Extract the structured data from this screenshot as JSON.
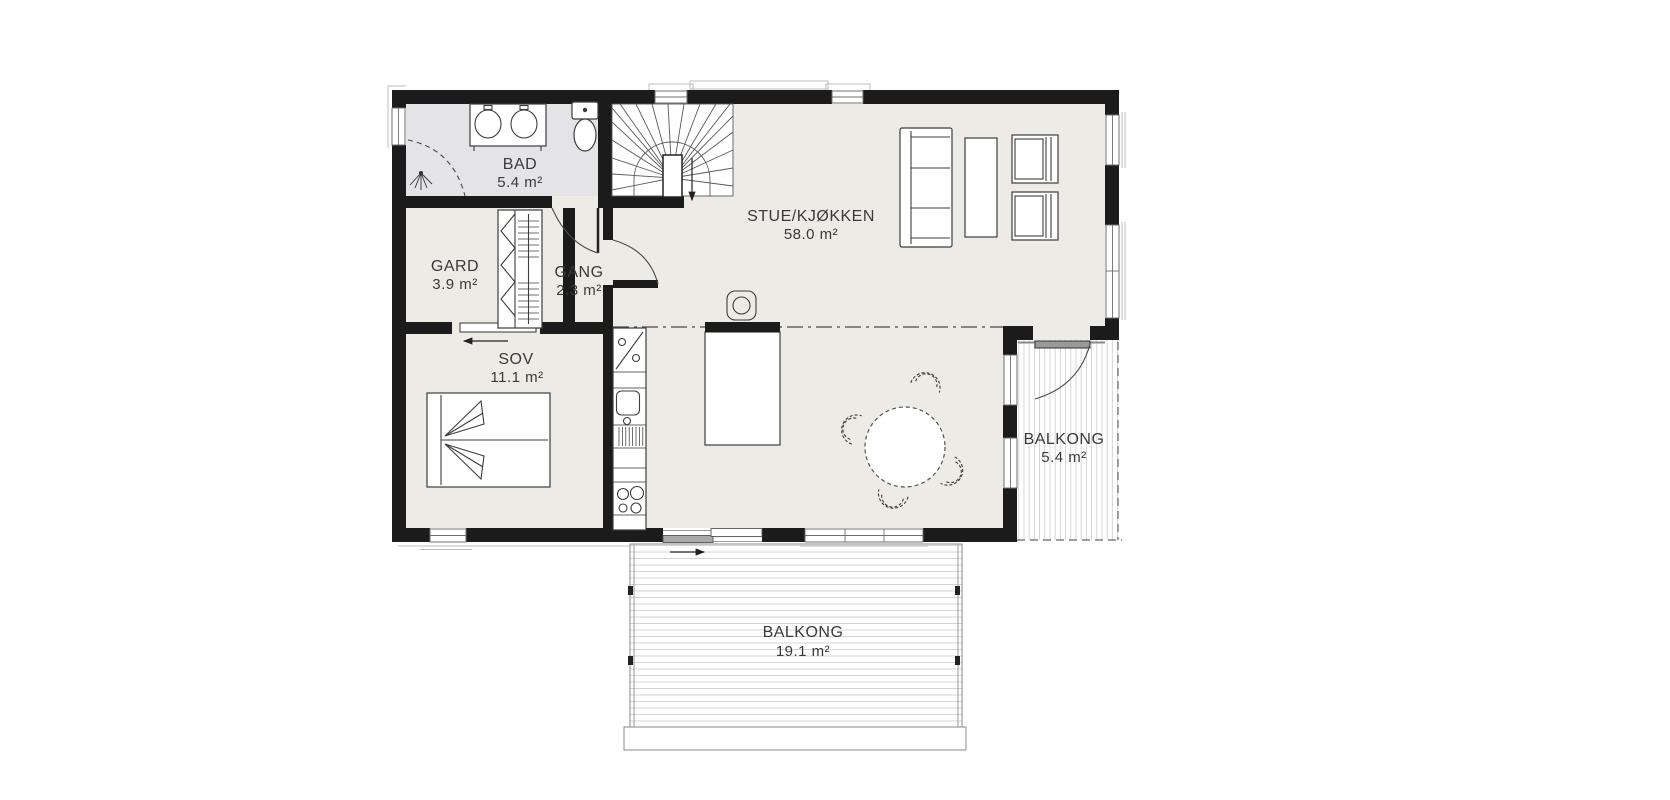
{
  "rooms": {
    "bad": {
      "label": "BAD",
      "area": "5.4 m²"
    },
    "gard": {
      "label": "GARD",
      "area": "3.9 m²"
    },
    "gang": {
      "label": "GANG",
      "area": "2.3 m²"
    },
    "sov": {
      "label": "SOV",
      "area": "11.1 m²"
    },
    "stue": {
      "label": "STUE/KJØKKEN",
      "area": "58.0 m²"
    },
    "balkong_side": {
      "label": "BALKONG",
      "area": "5.4 m²"
    },
    "balkong_front": {
      "label": "BALKONG",
      "area": "19.1 m²"
    }
  },
  "colors": {
    "wall": "#1b1b1b",
    "floor": "#ecebe6",
    "bathfloor": "#e4e4e7",
    "deckstripe": "#cfcfcf",
    "label": "#3a3a3a"
  },
  "furniture": [
    "stairs",
    "toilet",
    "double-sink",
    "shower",
    "wardrobe",
    "double-bed",
    "kitchen-counter",
    "dishwasher",
    "sink",
    "cooktop",
    "kitchen-island",
    "bar-stool",
    "dining-table",
    "dining-chair",
    "sofa",
    "coffee-table",
    "armchair",
    "armchair"
  ]
}
